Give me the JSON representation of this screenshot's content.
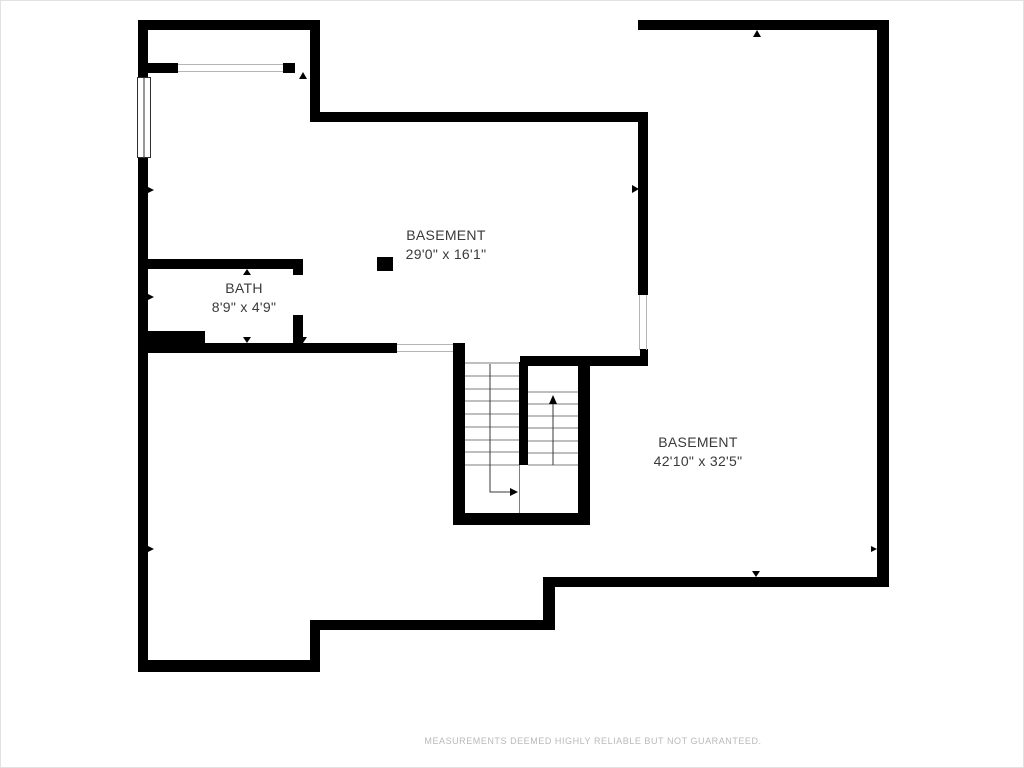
{
  "plan": {
    "type": "floor-plan",
    "level": "basement",
    "rooms": [
      {
        "name": "BASEMENT",
        "dims": "29'0\" x 16'1\""
      },
      {
        "name": "BATH",
        "dims": "8'9\" x 4'9\""
      },
      {
        "name": "BASEMENT",
        "dims": "42'10\" x 32'5\""
      }
    ],
    "footer": "MEASUREMENTS DEEMED HIGHLY RELIABLE BUT NOT GUARANTEED.",
    "colors": {
      "wall": "#000000",
      "label_text": "#3a3a3a",
      "footer_text": "#b9b9b9",
      "stair_tread": "#7d7d7d",
      "opening_line": "#b5b5b5"
    }
  }
}
